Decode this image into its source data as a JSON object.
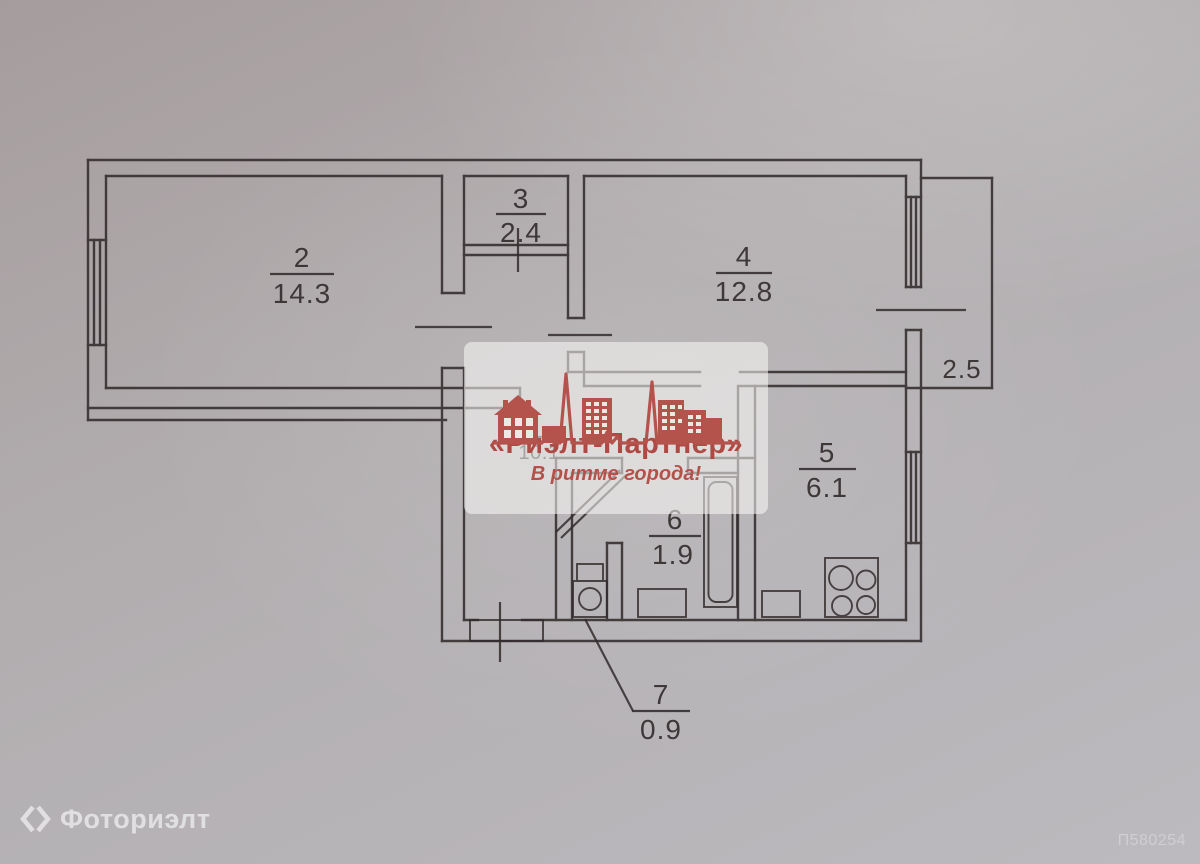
{
  "photo_id": "П580254",
  "agency_watermark": {
    "brand": "«Риэлт-Партнер»",
    "tagline": "В ритме города!",
    "accent_color": "#b4524b"
  },
  "photo_service_watermark": {
    "label": "Фоториэлт"
  },
  "floor_plan": {
    "rooms": [
      {
        "number": "2",
        "area": "14.3"
      },
      {
        "number": "3",
        "area": "2.4"
      },
      {
        "number": "4",
        "area": "12.8"
      },
      {
        "number": "5",
        "area": "6.1"
      },
      {
        "number": "6",
        "area": "1.9"
      },
      {
        "number": "7",
        "area": "0.9"
      }
    ],
    "hall_area": "10.1",
    "balcony_width": "2.5"
  }
}
